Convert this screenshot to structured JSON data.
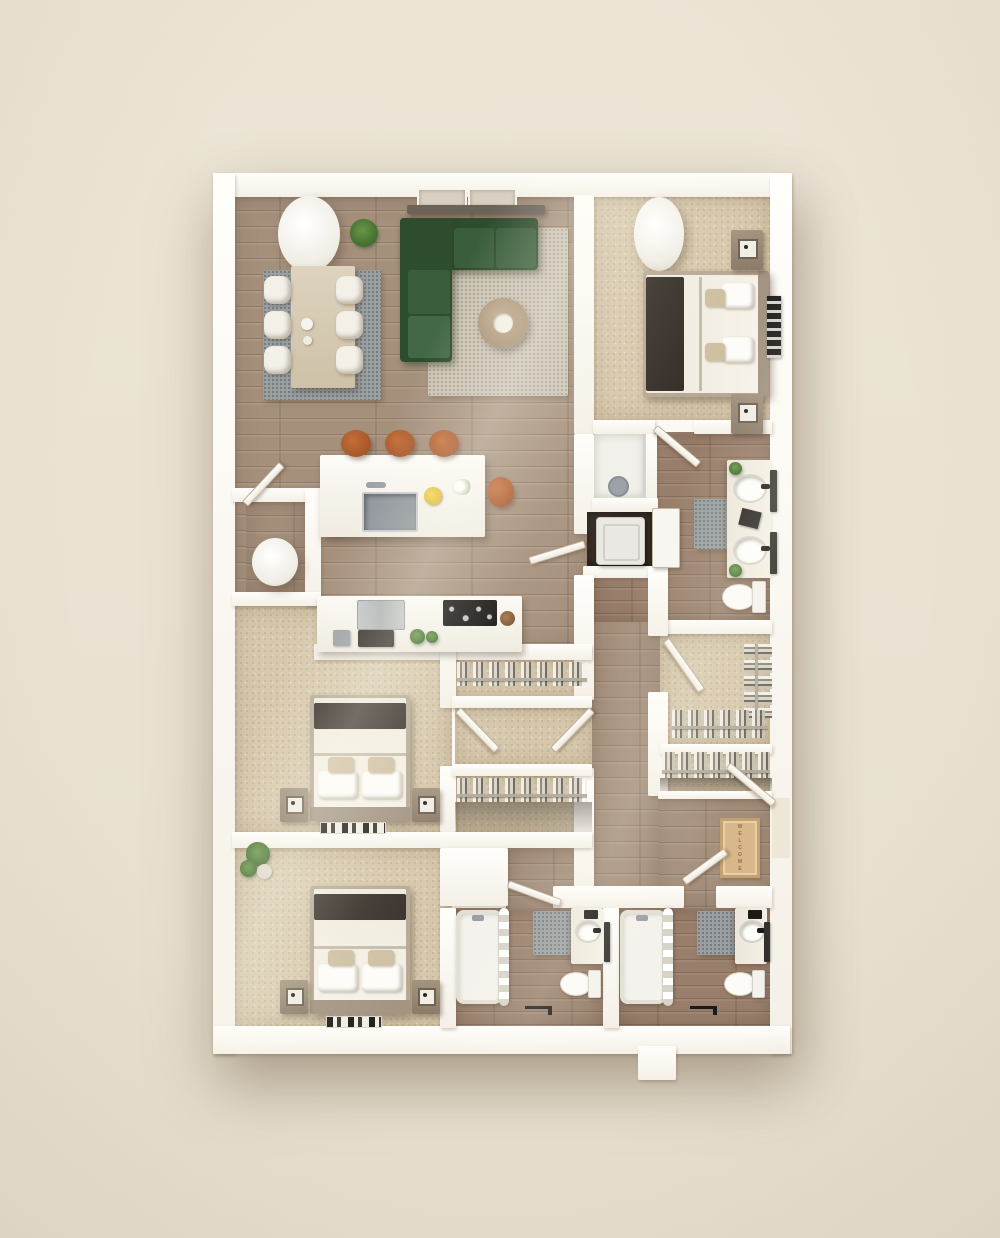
{
  "scene": {
    "description": "3D top-down rendering of an apartment floor plan",
    "background_color": "#e9e2d3",
    "wall_color": "#fbf9f3",
    "wood_floor_color": "#a5907c",
    "carpet_color": "#d7c9ad",
    "bath_tile_color": "#997f6b"
  },
  "labels": {
    "welcome_mat": "WELCOME"
  },
  "palette": {
    "sofa_green": "#31502f",
    "stool_leather": "#b05c2e",
    "blanket_dark": "#37302a",
    "lemon_yellow": "#e6c233",
    "plant_green": "#4c7a38",
    "gray_rug": "#9aa0a1",
    "beige_rug": "#cbc3b4",
    "welcome_mat_tan": "#d8b88a"
  },
  "rooms": [
    "living-dining-room",
    "kitchen",
    "bedroom-1",
    "primary-bathroom",
    "laundry-closet",
    "walk-in-closet",
    "coat-closet",
    "entry-hall",
    "hallway",
    "bedroom-2",
    "bedroom-3",
    "bathroom-2",
    "bathroom-3",
    "utility-closet",
    "linen-closet",
    "vestibule"
  ]
}
